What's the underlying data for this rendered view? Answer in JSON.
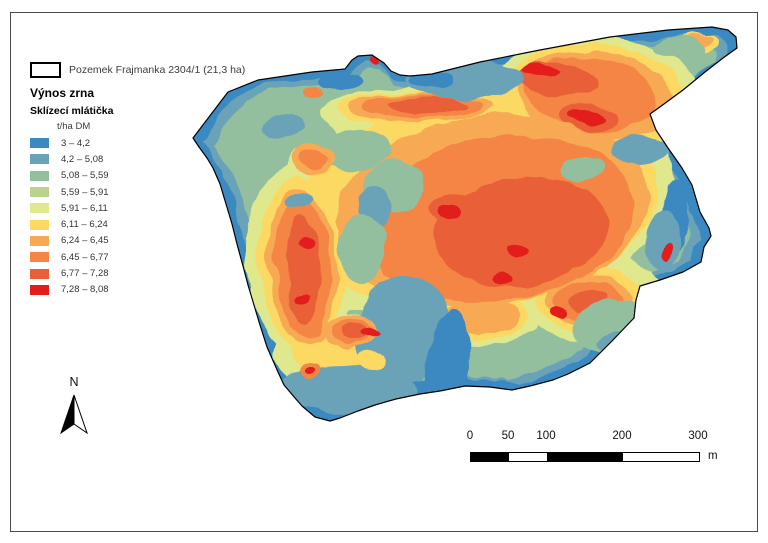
{
  "legend": {
    "field_symbol_label": "Pozemek Frajmanka 2304/1 (21,3 ha)",
    "title": "Výnos zrna",
    "subtitle": "Sklízecí mlátička",
    "unit_label": "t/ha DM",
    "classes": [
      {
        "range": "3 – 4,2",
        "color": "#3a89c0"
      },
      {
        "range": "4,2 – 5,08",
        "color": "#6aa2b8"
      },
      {
        "range": "5,08 – 5,59",
        "color": "#93bf9f"
      },
      {
        "range": "5,59 – 5,91",
        "color": "#b8d38e"
      },
      {
        "range": "5,91 – 6,11",
        "color": "#dfe88d"
      },
      {
        "range": "6,11 – 6,24",
        "color": "#fbd962"
      },
      {
        "range": "6,24 – 6,45",
        "color": "#f8a953"
      },
      {
        "range": "6,45 – 6,77",
        "color": "#f58545"
      },
      {
        "range": "6,77 – 7,28",
        "color": "#e85f38"
      },
      {
        "range": "7,28 – 8,08",
        "color": "#e31c1c"
      }
    ]
  },
  "north_arrow": {
    "label": "N"
  },
  "scale_bar": {
    "tick_labels": [
      "0",
      "50",
      "100",
      "200",
      "300"
    ],
    "unit": "m"
  }
}
